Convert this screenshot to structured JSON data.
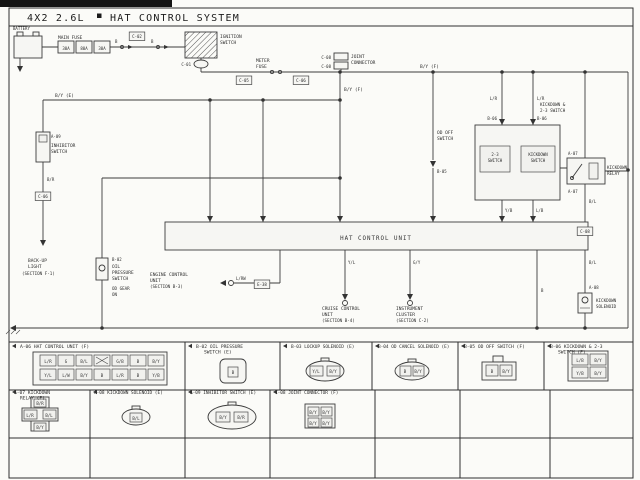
{
  "header": {
    "model": "4X2 2.6L",
    "system": "HAT CONTROL SYSTEM"
  },
  "unit": {
    "label": "HAT CONTROL UNIT"
  },
  "colors": {
    "line": "#3c3c3c",
    "paper": "#f6f6f3",
    "ink_title": "#1b1b1b"
  },
  "labels": [
    {
      "n": "battery-label",
      "t": "BATTERY",
      "x": 13,
      "y": 30,
      "s": 4
    },
    {
      "n": "main-fuse-label",
      "t": "MAIN FUSE",
      "x": 58,
      "y": 39,
      "s": 4.5
    },
    {
      "n": "fuse-value",
      "t": "30A",
      "x": 66,
      "y": 50,
      "s": 4,
      "a": "m"
    },
    {
      "n": "fuse-value",
      "t": "80A",
      "x": 84,
      "y": 50,
      "s": 4,
      "a": "m"
    },
    {
      "n": "fuse-value",
      "t": "30A",
      "x": 102,
      "y": 50,
      "s": 4,
      "a": "m"
    },
    {
      "n": "wire-label",
      "t": "B",
      "x": 115,
      "y": 43,
      "s": 4
    },
    {
      "n": "wire-label",
      "t": "B",
      "x": 151,
      "y": 43,
      "s": 4
    },
    {
      "n": "connector-code",
      "t": "C-02",
      "x": 137,
      "y": 38,
      "s": 4,
      "a": "m",
      "b": 1
    },
    {
      "n": "ignition-switch-label",
      "t": "IGNITION",
      "x": 220,
      "y": 38,
      "s": 4.5
    },
    {
      "n": "ignition-switch-label",
      "t": "SWITCH",
      "x": 220,
      "y": 44,
      "s": 4.5
    },
    {
      "n": "connector-code",
      "t": "C-01",
      "x": 191,
      "y": 66,
      "s": 4,
      "a": "e"
    },
    {
      "n": "meter-fuse-label",
      "t": "METER",
      "x": 256,
      "y": 62,
      "s": 4.5
    },
    {
      "n": "meter-fuse-label",
      "t": "FUSE",
      "x": 256,
      "y": 68,
      "s": 4.5
    },
    {
      "n": "connector-code",
      "t": "C-05",
      "x": 244,
      "y": 82,
      "s": 4,
      "a": "m",
      "b": 1
    },
    {
      "n": "connector-code",
      "t": "C-06",
      "x": 301,
      "y": 82,
      "s": 4,
      "a": "m",
      "b": 1
    },
    {
      "n": "connector-code",
      "t": "C-08",
      "x": 331,
      "y": 59,
      "s": 4,
      "a": "e"
    },
    {
      "n": "connector-code",
      "t": "C-08",
      "x": 331,
      "y": 68,
      "s": 4,
      "a": "e"
    },
    {
      "n": "joint-connector-label",
      "t": "JOINT",
      "x": 351,
      "y": 58,
      "s": 4.5
    },
    {
      "n": "joint-connector-label",
      "t": "CONNECTOR",
      "x": 351,
      "y": 64,
      "s": 4.5
    },
    {
      "n": "wire-label",
      "t": "B/Y (F)",
      "x": 344,
      "y": 91,
      "s": 4.5
    },
    {
      "n": "wire-label",
      "t": "B/Y (F)",
      "x": 420,
      "y": 68,
      "s": 4.5
    },
    {
      "n": "wire-label",
      "t": "B/Y (E)",
      "x": 55,
      "y": 97,
      "s": 4.5
    },
    {
      "n": "connector-code",
      "t": "A-09",
      "x": 51,
      "y": 138,
      "s": 4
    },
    {
      "n": "inhibitor-switch-label",
      "t": "INHIBITOR",
      "x": 51,
      "y": 147,
      "s": 4.5
    },
    {
      "n": "inhibitor-switch-label",
      "t": "SWITCH",
      "x": 51,
      "y": 153,
      "s": 4.5
    },
    {
      "n": "wire-label",
      "t": "B/R",
      "x": 47,
      "y": 181,
      "s": 4
    },
    {
      "n": "connector-code",
      "t": "C-06",
      "x": 43,
      "y": 198,
      "s": 4,
      "a": "m",
      "b": 1
    },
    {
      "n": "backup-light-ref",
      "t": "BACK-UP",
      "x": 28,
      "y": 262,
      "s": 4.5
    },
    {
      "n": "backup-light-ref",
      "t": "LIGHT",
      "x": 28,
      "y": 268,
      "s": 4.5
    },
    {
      "n": "backup-light-ref",
      "t": "(SECTION F-1)",
      "x": 22,
      "y": 275,
      "s": 4.2
    },
    {
      "n": "connector-code",
      "t": "B-02",
      "x": 112,
      "y": 261,
      "s": 4
    },
    {
      "n": "oil-pressure-switch-label",
      "t": "OIL",
      "x": 112,
      "y": 268,
      "s": 4.5
    },
    {
      "n": "oil-pressure-switch-label",
      "t": "PRESSURE",
      "x": 112,
      "y": 274,
      "s": 4.5
    },
    {
      "n": "oil-pressure-switch-label",
      "t": "SWITCH",
      "x": 112,
      "y": 280,
      "s": 4.5
    },
    {
      "n": "oil-pressure-switch-note",
      "t": "OD GEAR",
      "x": 112,
      "y": 290,
      "s": 4.2
    },
    {
      "n": "oil-pressure-switch-note",
      "t": "ON",
      "x": 112,
      "y": 296,
      "s": 4.2
    },
    {
      "n": "engine-control-ref",
      "t": "ENGINE CONTROL",
      "x": 150,
      "y": 276,
      "s": 4.5
    },
    {
      "n": "engine-control-ref",
      "t": "UNIT",
      "x": 150,
      "y": 282,
      "s": 4.5
    },
    {
      "n": "engine-control-ref",
      "t": "(SECTION B-3)",
      "x": 150,
      "y": 288,
      "s": 4.2
    },
    {
      "n": "wire-label",
      "t": "L/RW",
      "x": 236,
      "y": 280,
      "s": 4
    },
    {
      "n": "connector-code",
      "t": "E-38",
      "x": 262,
      "y": 286,
      "s": 4,
      "a": "m",
      "b": 1
    },
    {
      "n": "wire-label",
      "t": "Y/L",
      "x": 348,
      "y": 264,
      "s": 4
    },
    {
      "n": "cruise-control-ref",
      "t": "CRUISE CONTROL",
      "x": 322,
      "y": 310,
      "s": 4.5
    },
    {
      "n": "cruise-control-ref",
      "t": "UNIT",
      "x": 322,
      "y": 316,
      "s": 4.5
    },
    {
      "n": "cruise-control-ref",
      "t": "(SECTION B-4)",
      "x": 322,
      "y": 322,
      "s": 4.2
    },
    {
      "n": "wire-label",
      "t": "G/Y",
      "x": 413,
      "y": 264,
      "s": 4
    },
    {
      "n": "instrument-cluster-ref",
      "t": "INSTRUMENT",
      "x": 396,
      "y": 310,
      "s": 4.5
    },
    {
      "n": "instrument-cluster-ref",
      "t": "CLUSTER",
      "x": 396,
      "y": 316,
      "s": 4.5
    },
    {
      "n": "instrument-cluster-ref",
      "t": "(SECTION C-2)",
      "x": 396,
      "y": 322,
      "s": 4.2
    },
    {
      "n": "od-off-switch-label",
      "t": "OD OFF",
      "x": 437,
      "y": 134,
      "s": 4.5
    },
    {
      "n": "od-off-switch-label",
      "t": "SWITCH",
      "x": 437,
      "y": 140,
      "s": 4.5
    },
    {
      "n": "connector-code",
      "t": "B-05",
      "x": 437,
      "y": 173,
      "s": 4
    },
    {
      "n": "wire-label",
      "t": "L/R",
      "x": 497,
      "y": 100,
      "s": 4,
      "a": "e"
    },
    {
      "n": "wire-label",
      "t": "L/R",
      "x": 537,
      "y": 100,
      "s": 4
    },
    {
      "n": "connector-code",
      "t": "B-06",
      "x": 497,
      "y": 120,
      "s": 4,
      "a": "e"
    },
    {
      "n": "connector-code",
      "t": "B-06",
      "x": 537,
      "y": 120,
      "s": 4
    },
    {
      "n": "switch-box-title",
      "t": "KICKDOWN &",
      "x": 540,
      "y": 106,
      "s": 4.2
    },
    {
      "n": "switch-box-title",
      "t": "2-3 SWITCH",
      "x": 540,
      "y": 112,
      "s": 4.2
    },
    {
      "n": "switch-label",
      "t": "2-3",
      "x": 495,
      "y": 156,
      "s": 4,
      "a": "m"
    },
    {
      "n": "switch-label",
      "t": "SWITCH",
      "x": 495,
      "y": 162,
      "s": 4,
      "a": "m"
    },
    {
      "n": "switch-label",
      "t": "KICKDOWN",
      "x": 538,
      "y": 156,
      "s": 4,
      "a": "m"
    },
    {
      "n": "switch-label",
      "t": "SWITCH",
      "x": 538,
      "y": 162,
      "s": 4,
      "a": "m"
    },
    {
      "n": "wire-label",
      "t": "Y/B",
      "x": 505,
      "y": 212,
      "s": 4
    },
    {
      "n": "wire-label",
      "t": "L/B",
      "x": 536,
      "y": 212,
      "s": 4
    },
    {
      "n": "connector-code",
      "t": "A-07",
      "x": 568,
      "y": 155,
      "s": 4
    },
    {
      "n": "connector-code",
      "t": "A-07",
      "x": 568,
      "y": 193,
      "s": 4
    },
    {
      "n": "kickdown-relay-label",
      "t": "KICKDOWN",
      "x": 607,
      "y": 169,
      "s": 4.2
    },
    {
      "n": "kickdown-relay-label",
      "t": "RELAY",
      "x": 607,
      "y": 175,
      "s": 4.2
    },
    {
      "n": "wire-label",
      "t": "B/L",
      "x": 589,
      "y": 203,
      "s": 4
    },
    {
      "n": "connector-code",
      "t": "C-08",
      "x": 585,
      "y": 233,
      "s": 4,
      "a": "m",
      "b": 1
    },
    {
      "n": "wire-label",
      "t": "B/L",
      "x": 589,
      "y": 264,
      "s": 4
    },
    {
      "n": "connector-code",
      "t": "A-08",
      "x": 589,
      "y": 289,
      "s": 4
    },
    {
      "n": "kickdown-solenoid-label",
      "t": "KICKDOWN",
      "x": 596,
      "y": 302,
      "s": 4.2
    },
    {
      "n": "kickdown-solenoid-label",
      "t": "SOLENOID",
      "x": 596,
      "y": 308,
      "s": 4.2
    },
    {
      "n": "wire-label",
      "t": "B",
      "x": 541,
      "y": 292,
      "s": 4
    },
    {
      "n": "grid-header",
      "t": "A-06 HAT CONTROL UNIT (F)",
      "x": 20,
      "y": 348,
      "s": 4.6
    },
    {
      "n": "grid-header",
      "t": "B-02 OIL PRESSURE",
      "x": 196,
      "y": 348,
      "s": 4.6
    },
    {
      "n": "grid-header",
      "t": "SWITCH (E)",
      "x": 204,
      "y": 353.5,
      "s": 4.6
    },
    {
      "n": "grid-header",
      "t": "B-03 LOCKUP SOLENOID (E)",
      "x": 291,
      "y": 348,
      "s": 4.4
    },
    {
      "n": "grid-header",
      "t": "B-04 OD CANCEL SOLENOID (E)",
      "x": 378,
      "y": 348,
      "s": 4.4
    },
    {
      "n": "grid-header",
      "t": "B-05 OD OFF SWITCH (F)",
      "x": 464,
      "y": 348,
      "s": 4.6
    },
    {
      "n": "grid-header",
      "t": "B-06 KICKDOWN & 2-3",
      "x": 550,
      "y": 348,
      "s": 4.6
    },
    {
      "n": "grid-header",
      "t": "SWITCH (F)",
      "x": 558,
      "y": 353.5,
      "s": 4.6
    },
    {
      "n": "grid-header",
      "t": "A-07 KICKDOWN",
      "x": 14,
      "y": 394,
      "s": 4.6
    },
    {
      "n": "grid-header",
      "t": "RELAY (F)",
      "x": 20,
      "y": 399.5,
      "s": 4.6
    },
    {
      "n": "grid-header",
      "t": "A-08 KICKDOWN SOLENOID (E)",
      "x": 94,
      "y": 394,
      "s": 4.4
    },
    {
      "n": "grid-header",
      "t": "A-09 INHIBITOR SWITCH (E)",
      "x": 190,
      "y": 394,
      "s": 4.4
    },
    {
      "n": "grid-header",
      "t": "C-08 JOINT CONNECTOR (F)",
      "x": 275,
      "y": 394,
      "s": 4.4
    },
    {
      "n": "pin-label",
      "t": "L/R",
      "x": 48,
      "y": 363,
      "s": 4,
      "a": "m"
    },
    {
      "n": "pin-label",
      "t": "G",
      "x": 66,
      "y": 363,
      "s": 4,
      "a": "m"
    },
    {
      "n": "pin-label",
      "t": "B/L",
      "x": 84,
      "y": 363,
      "s": 4,
      "a": "m"
    },
    {
      "n": "pin-label",
      "t": "G/B",
      "x": 120,
      "y": 363,
      "s": 4,
      "a": "m"
    },
    {
      "n": "pin-label",
      "t": "B",
      "x": 138,
      "y": 363,
      "s": 4,
      "a": "m"
    },
    {
      "n": "pin-label",
      "t": "B/Y",
      "x": 156,
      "y": 363,
      "s": 4,
      "a": "m"
    },
    {
      "n": "pin-label",
      "t": "Y/L",
      "x": 48,
      "y": 377,
      "s": 4,
      "a": "m"
    },
    {
      "n": "pin-label",
      "t": "L/W",
      "x": 66,
      "y": 377,
      "s": 4,
      "a": "m"
    },
    {
      "n": "pin-label",
      "t": "B/Y",
      "x": 84,
      "y": 377,
      "s": 4,
      "a": "m"
    },
    {
      "n": "pin-label",
      "t": "B",
      "x": 102,
      "y": 377,
      "s": 4,
      "a": "m"
    },
    {
      "n": "pin-label",
      "t": "L/R",
      "x": 120,
      "y": 377,
      "s": 4,
      "a": "m"
    },
    {
      "n": "pin-label",
      "t": "B",
      "x": 138,
      "y": 377,
      "s": 4,
      "a": "m"
    },
    {
      "n": "pin-label",
      "t": "Y/B",
      "x": 156,
      "y": 377,
      "s": 4,
      "a": "m"
    },
    {
      "n": "pin-label",
      "t": "B",
      "x": 233,
      "y": 374,
      "s": 4,
      "a": "m"
    },
    {
      "n": "pin-label",
      "t": "Y/L",
      "x": 316,
      "y": 373,
      "s": 4,
      "a": "m"
    },
    {
      "n": "pin-label",
      "t": "B/Y",
      "x": 333,
      "y": 373,
      "s": 4,
      "a": "m"
    },
    {
      "n": "pin-label",
      "t": "B",
      "x": 405,
      "y": 373,
      "s": 4,
      "a": "m"
    },
    {
      "n": "pin-label",
      "t": "B/Y",
      "x": 418,
      "y": 373,
      "s": 4,
      "a": "m"
    },
    {
      "n": "pin-label",
      "t": "B",
      "x": 492,
      "y": 373,
      "s": 4,
      "a": "m"
    },
    {
      "n": "pin-label",
      "t": "B/Y",
      "x": 506,
      "y": 373,
      "s": 4,
      "a": "m"
    },
    {
      "n": "pin-label",
      "t": "L/B",
      "x": 580,
      "y": 362,
      "s": 4,
      "a": "m"
    },
    {
      "n": "pin-label",
      "t": "B/Y",
      "x": 598,
      "y": 362,
      "s": 4,
      "a": "m"
    },
    {
      "n": "pin-label",
      "t": "Y/B",
      "x": 580,
      "y": 375,
      "s": 4,
      "a": "m"
    },
    {
      "n": "pin-label",
      "t": "B/Y",
      "x": 598,
      "y": 375,
      "s": 4,
      "a": "m"
    },
    {
      "n": "pin-label",
      "t": "B/R",
      "x": 40,
      "y": 405,
      "s": 4,
      "a": "m"
    },
    {
      "n": "pin-label",
      "t": "L/R",
      "x": 30,
      "y": 417,
      "s": 4,
      "a": "m"
    },
    {
      "n": "pin-label",
      "t": "B/L",
      "x": 49,
      "y": 417,
      "s": 4,
      "a": "m"
    },
    {
      "n": "pin-label",
      "t": "B/Y",
      "x": 40,
      "y": 429,
      "s": 4,
      "a": "m"
    },
    {
      "n": "pin-label",
      "t": "B/L",
      "x": 136,
      "y": 420,
      "s": 4,
      "a": "m"
    },
    {
      "n": "pin-label",
      "t": "B/Y",
      "x": 223,
      "y": 419,
      "s": 4,
      "a": "m"
    },
    {
      "n": "pin-label",
      "t": "B/R",
      "x": 241,
      "y": 419,
      "s": 4,
      "a": "m"
    },
    {
      "n": "pin-label",
      "t": "B/Y",
      "x": 313,
      "y": 414,
      "s": 4,
      "a": "m"
    },
    {
      "n": "pin-label",
      "t": "B/Y",
      "x": 326,
      "y": 414,
      "s": 4,
      "a": "m"
    },
    {
      "n": "pin-label",
      "t": "B/Y",
      "x": 313,
      "y": 425,
      "s": 4,
      "a": "m"
    },
    {
      "n": "pin-label",
      "t": "B/Y",
      "x": 326,
      "y": 425,
      "s": 4,
      "a": "m"
    }
  ]
}
